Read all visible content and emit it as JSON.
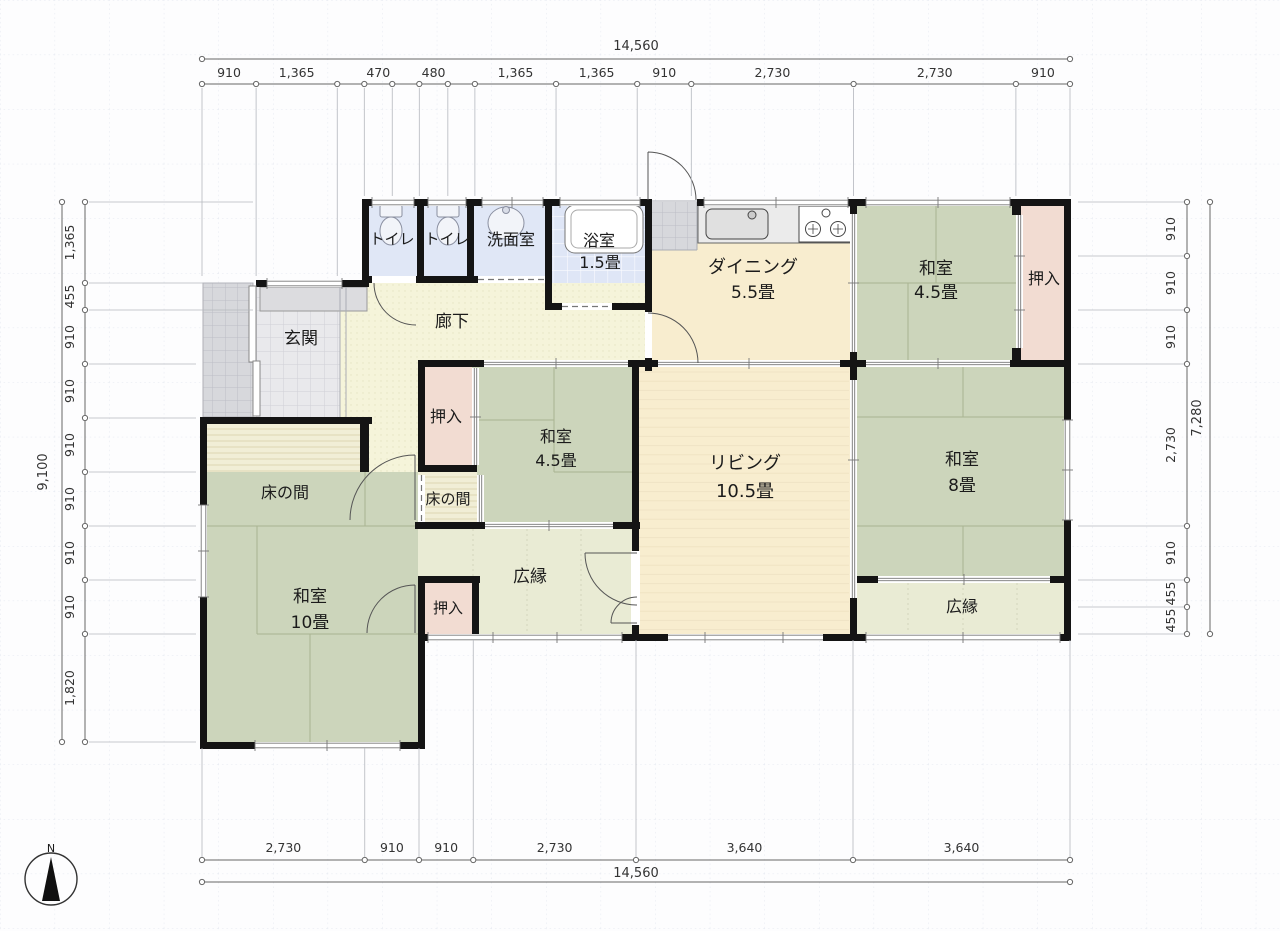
{
  "compass": {
    "label": "N"
  },
  "colors": {
    "tatami": "#ccd5bb",
    "living": "#f8edcf",
    "dining": "#f8edcf",
    "closet": "#f2dcd2",
    "wet": "#e0e7f6",
    "corridor": "#f5f4da",
    "veranda": "#e9ebd4",
    "wall": "#141414"
  },
  "rooms": {
    "toilet1": {
      "name": "トイレ"
    },
    "toilet2": {
      "name": "トイレ"
    },
    "washroom": {
      "name": "洗面室"
    },
    "bath": {
      "name": "浴室",
      "size": "1.5畳"
    },
    "dining": {
      "name": "ダイニング",
      "size": "5.5畳"
    },
    "washitsu_tr": {
      "name": "和室",
      "size": "4.5畳"
    },
    "oshiire_tr": {
      "name": "押入"
    },
    "genkan": {
      "name": "玄関"
    },
    "rouka": {
      "name": "廊下"
    },
    "oshiire_mid": {
      "name": "押入"
    },
    "washitsu_mid": {
      "name": "和室",
      "size": "4.5畳"
    },
    "tokonoma_left": {
      "name": "床の間"
    },
    "tokonoma_mid": {
      "name": "床の間"
    },
    "washitsu10": {
      "name": "和室",
      "size": "10畳"
    },
    "oshiire_btm": {
      "name": "押入"
    },
    "hiroen_c": {
      "name": "広縁"
    },
    "living": {
      "name": "リビング",
      "size": "10.5畳"
    },
    "washitsu8": {
      "name": "和室",
      "size": "8畳"
    },
    "hiroen_r": {
      "name": "広縁"
    }
  },
  "dimensions": {
    "top": {
      "total": "14,560",
      "segments": [
        {
          "mm": 910,
          "label": "910"
        },
        {
          "mm": 1365,
          "label": "1,365"
        },
        {
          "mm": 455,
          "label": ""
        },
        {
          "mm": 470,
          "label": "470"
        },
        {
          "mm": 455,
          "label": ""
        },
        {
          "mm": 480,
          "label": "480"
        },
        {
          "mm": 455,
          "label": ""
        },
        {
          "mm": 1365,
          "label": "1,365"
        },
        {
          "mm": 1365,
          "label": "1,365"
        },
        {
          "mm": 910,
          "label": "910"
        },
        {
          "mm": 2730,
          "label": "2,730"
        },
        {
          "mm": 2730,
          "label": "2,730"
        },
        {
          "mm": 910,
          "label": "910"
        }
      ]
    },
    "bottom": {
      "total": "14,560",
      "segments": [
        {
          "mm": 2730,
          "label": "2,730"
        },
        {
          "mm": 910,
          "label": "910"
        },
        {
          "mm": 910,
          "label": "910"
        },
        {
          "mm": 2730,
          "label": "2,730"
        },
        {
          "mm": 3640,
          "label": "3,640"
        },
        {
          "mm": 3640,
          "label": "3,640"
        }
      ]
    },
    "left": {
      "total": "9,100",
      "segments": [
        {
          "mm": 1365,
          "label": "1,365"
        },
        {
          "mm": 455,
          "label": "455"
        },
        {
          "mm": 910,
          "label": "910"
        },
        {
          "mm": 910,
          "label": "910"
        },
        {
          "mm": 910,
          "label": "910"
        },
        {
          "mm": 910,
          "label": "910"
        },
        {
          "mm": 910,
          "label": "910"
        },
        {
          "mm": 910,
          "label": "910"
        },
        {
          "mm": 1820,
          "label": "1,820"
        }
      ]
    },
    "right": {
      "total": "7,280",
      "segments": [
        {
          "mm": 910,
          "label": "910"
        },
        {
          "mm": 910,
          "label": "910"
        },
        {
          "mm": 910,
          "label": "910"
        },
        {
          "mm": 2730,
          "label": "2,730"
        },
        {
          "mm": 910,
          "label": "910"
        },
        {
          "mm": 455,
          "label": "455"
        },
        {
          "mm": 455,
          "label": "455"
        }
      ]
    }
  }
}
